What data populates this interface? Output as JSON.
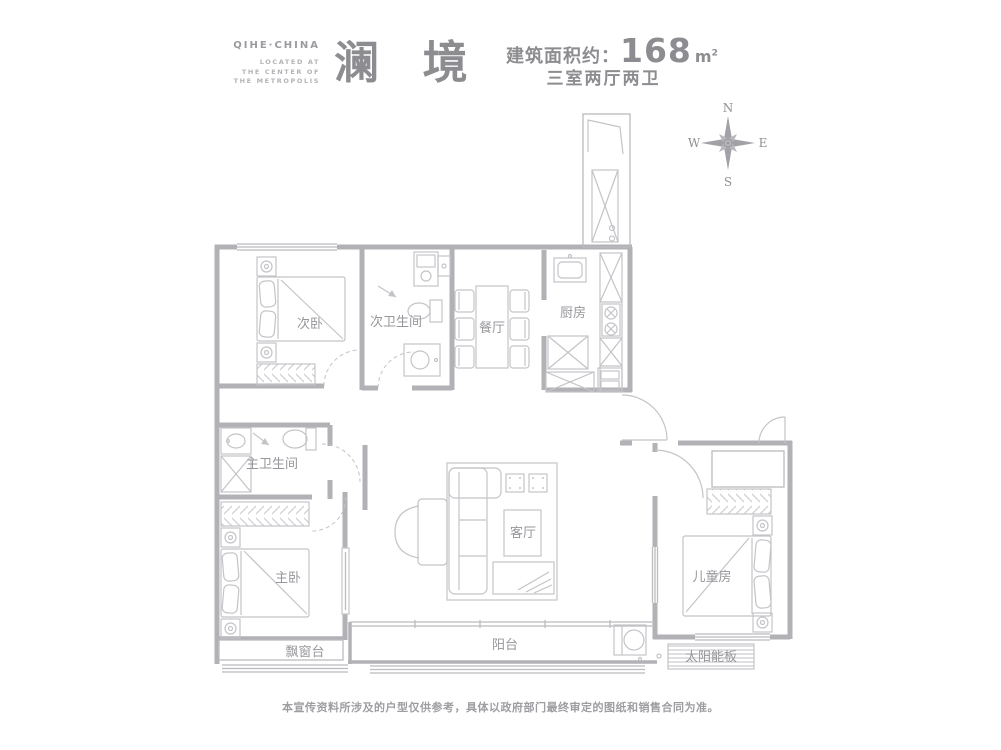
{
  "header": {
    "brand": "QIHE·CHINA",
    "brand_sub_1": "LOCATED AT",
    "brand_sub_2": "THE CENTER OF",
    "brand_sub_3": "THE METROPOLIS",
    "title": "澜 境",
    "area_label": "建筑面积约：",
    "area_value": "168",
    "area_unit_base": "m",
    "area_unit_sup": "2",
    "layout_text": "三室两厅两卫"
  },
  "compass": {
    "north": "N",
    "south": "S",
    "east": "E",
    "west": "W"
  },
  "rooms": {
    "secondary_bedroom": "次卧",
    "secondary_bathroom": "次卫生间",
    "dining": "餐厅",
    "kitchen": "厨房",
    "master_bathroom": "主卫生间",
    "master_bedroom": "主卧",
    "living": "客厅",
    "children_room": "儿童房",
    "bay_window": "飘窗台",
    "balcony": "阳台",
    "solar_panel": "太阳能板"
  },
  "footer": {
    "disclaimer": "本宣传资料所涉及的户型仅供参考，具体以政府部门最终审定的图纸和销售合同为准。"
  },
  "colors": {
    "wall": "#b2b2b6",
    "furniture": "#c4c4c8",
    "label": "#97979b",
    "text": "#8d8d91"
  }
}
